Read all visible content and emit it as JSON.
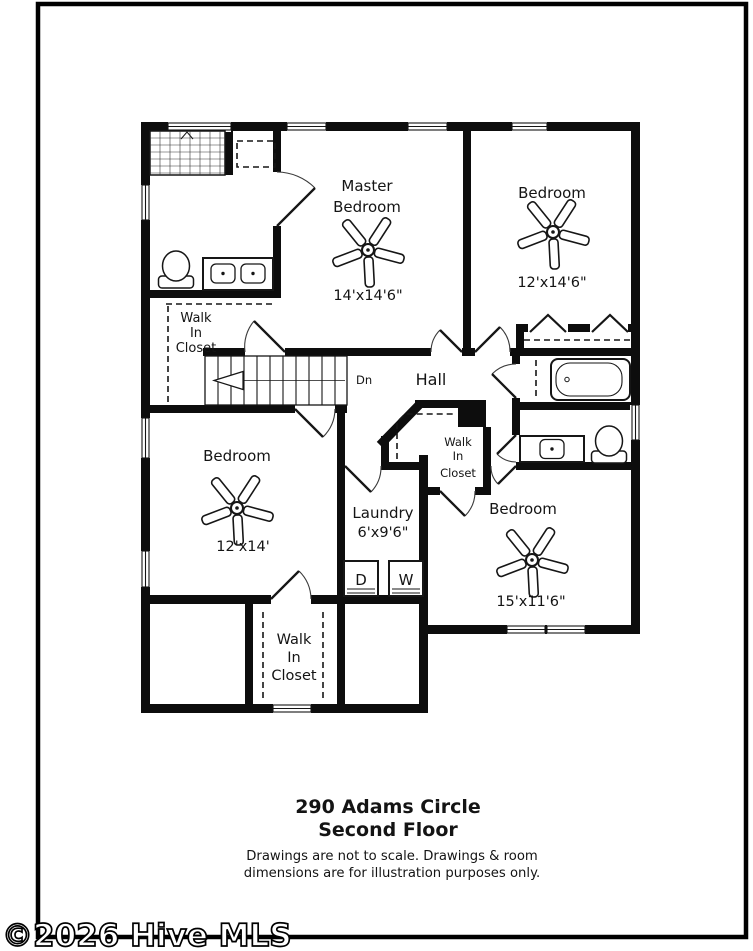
{
  "page": {
    "background": "#ffffff",
    "line_color": "#0d0d0d"
  },
  "floor_plan": {
    "rooms": {
      "master_bedroom": {
        "name_line1": "Master",
        "name_line2": "Bedroom",
        "dimensions": "14'x14'6\""
      },
      "bedroom_top_right": {
        "name": "Bedroom",
        "dimensions": "12'x14'6\""
      },
      "bedroom_left": {
        "name": "Bedroom",
        "dimensions": "12'x14'"
      },
      "bedroom_bottom_right": {
        "name": "Bedroom",
        "dimensions": "15'x11'6\""
      },
      "laundry": {
        "name": "Laundry",
        "dimensions": "6'x9'6\""
      },
      "hall": {
        "name": "Hall"
      },
      "walk_in_closet_left": {
        "name_line1": "Walk",
        "name_line2": "In",
        "name_line3": "Closet"
      },
      "walk_in_closet_middle": {
        "name_line1": "Walk",
        "name_line2": "In",
        "name_line3": "Closet"
      },
      "walk_in_closet_bottom": {
        "name_line1": "Walk",
        "name_line2": "In",
        "name_line3": "Closet"
      }
    },
    "stairs": {
      "direction_label": "Dn"
    },
    "appliances": {
      "dryer_label": "D",
      "washer_label": "W"
    }
  },
  "footer": {
    "address_line1": "290 Adams Circle",
    "address_line2": "Second Floor",
    "disclaimer_line1": "Drawings are not to scale. Drawings & room",
    "disclaimer_line2": "dimensions are for illustration purposes only."
  },
  "watermark": {
    "text": "©2026 Hive MLS"
  }
}
